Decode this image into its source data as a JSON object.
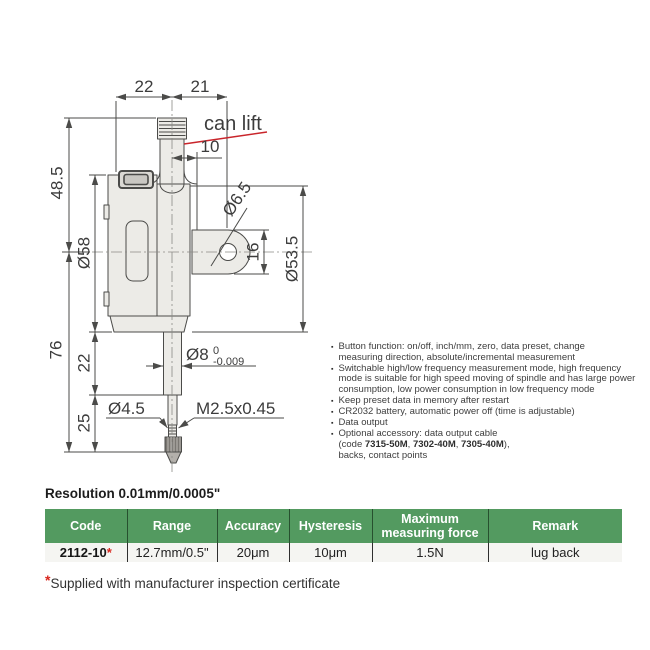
{
  "colors": {
    "table_header_bg": "#539a60",
    "accent_red": "#d8251c",
    "leader_red": "#c9252b"
  },
  "drawing": {
    "dim_stem_to_body_width": "22",
    "dim_stem_to_lug_hole": "21",
    "can_lift_label": "can lift",
    "dim_stem_diameter": "10",
    "dim_top_height": "48.5",
    "dim_body_diameter": "Ø58",
    "dim_lower_height": "76",
    "dim_spindle_travel": "22",
    "dim_tip_length": "25",
    "dim_lug_hole_diameter": "Ø6.5",
    "dim_lug_width": "16",
    "dim_back_diameter": "Ø53.5",
    "dim_spindle_diameter": "Ø8",
    "tolerance_upper": "0",
    "tolerance_lower": "-0.009",
    "dim_contact_diameter": "Ø4.5",
    "thread_spec": "M2.5x0.45"
  },
  "features": {
    "bullet_glyph": "▪",
    "items": [
      {
        "text": "Button function: on/off, inch/mm, zero, data preset, change\nmeasuring direction, absolute/incremental measurement"
      },
      {
        "text": "Switchable high/low frequency measurement mode, high frequency\nmode is suitable for high speed moving of spindle and has large power\nconsumption, low power consumption in low frequency mode"
      },
      {
        "text": "Keep preset data in memory after restart"
      },
      {
        "text": "CR2032 battery, automatic power off (time is adjustable)"
      },
      {
        "text": "Data output"
      },
      {
        "pre": "Optional accessory: data output cable\n(code ",
        "code1": "7315-50M",
        "sep1": ", ",
        "code2": "7302-40M",
        "sep2": ", ",
        "code3": "7305-40M",
        "post": "),\nbacks, contact points"
      }
    ]
  },
  "resolution_note": "Resolution 0.01mm/0.0005\"",
  "table": {
    "headers": [
      "Code",
      "Range",
      "Accuracy",
      "Hysteresis",
      "Maximum measuring force",
      "Remark"
    ],
    "row": {
      "code": "2112-10",
      "asterisk": "*",
      "range": "12.7mm/0.5\"",
      "accuracy": "20μm",
      "hysteresis": "10μm",
      "max_force": "1.5N",
      "remark": "lug back"
    }
  },
  "footnote": {
    "asterisk": "*",
    "text": "Supplied with manufacturer inspection certificate"
  }
}
